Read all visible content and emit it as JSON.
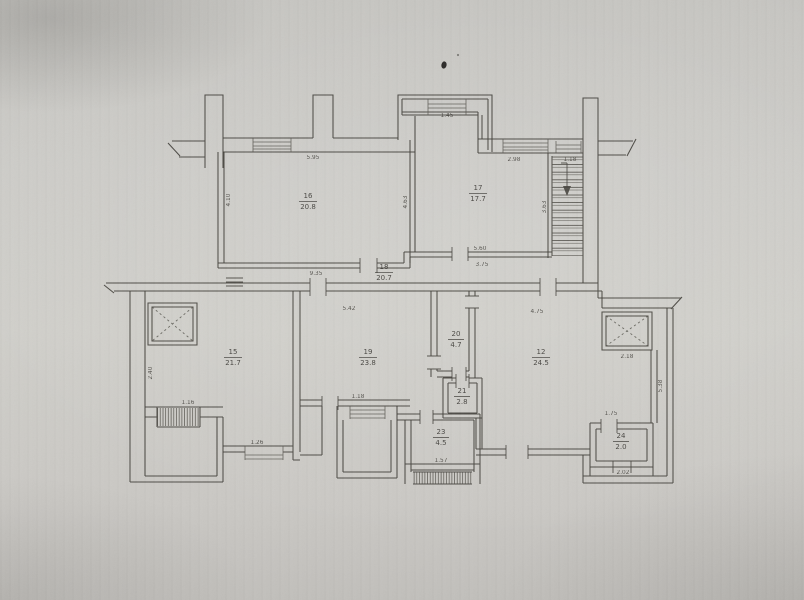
{
  "document": {
    "type": "scanned-floor-plan",
    "description": "Technical floor plan of an apartment level, scanned on gray paper"
  },
  "colors": {
    "paper": "#cdccc8",
    "ink": "#45433e",
    "label_ink": "#3a3834"
  },
  "rooms": [
    {
      "number": "16",
      "area": "20.8"
    },
    {
      "number": "17",
      "area": "17.7"
    },
    {
      "number": "18",
      "area": "20.7"
    },
    {
      "number": "15",
      "area": "21.7"
    },
    {
      "number": "19",
      "area": "23.8"
    },
    {
      "number": "20",
      "area": "4.7"
    },
    {
      "number": "21",
      "area": "2.8"
    },
    {
      "number": "12",
      "area": "24.5"
    },
    {
      "number": "23",
      "area": "4.5"
    },
    {
      "number": "24",
      "area": "2.0"
    }
  ],
  "dims": [
    {
      "text": "4.10"
    },
    {
      "text": "5.95"
    },
    {
      "text": "1.45"
    },
    {
      "text": "2.98"
    },
    {
      "text": "1.18"
    },
    {
      "text": "4.63"
    },
    {
      "text": "3.63"
    },
    {
      "text": "5.60"
    },
    {
      "text": "3.75"
    },
    {
      "text": "9.35"
    },
    {
      "text": "5.42"
    },
    {
      "text": "4.75"
    },
    {
      "text": "2.18"
    },
    {
      "text": "2.40"
    },
    {
      "text": "1.16"
    },
    {
      "text": "1.18"
    },
    {
      "text": "1.26"
    },
    {
      "text": "1.57"
    },
    {
      "text": "1.75"
    },
    {
      "text": "2.02"
    },
    {
      "text": "5.38"
    }
  ],
  "icons": [
    {
      "name": "stairs-down-arrow",
      "meaning": "stair run direction, pointing down"
    },
    {
      "name": "elevator-x-left",
      "meaning": "elevator shaft"
    },
    {
      "name": "elevator-x-right",
      "meaning": "elevator shaft"
    }
  ]
}
